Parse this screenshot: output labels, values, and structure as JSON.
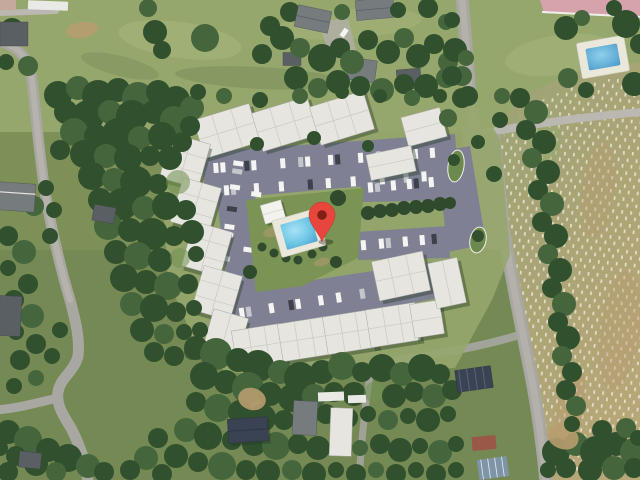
{
  "app": {
    "title": "Satellite map view",
    "description": "Aerial satellite view of an apartment complex with parking loop, central swimming pool and a red dropped-pin location marker; cemetery field on the right, residential houses and tree cover around"
  },
  "marker": {
    "name": "dropped-pin",
    "transform": "translate(322,202)",
    "body_color": "#e8453c",
    "dot_color": "#7e2015",
    "shadow_opacity": "0.3"
  },
  "colors": {
    "grass_base": "#7d9058",
    "grass_field": "#96a76d",
    "grass_light": "#adba80",
    "grass_dark": "#6d8150",
    "forest_dark": "#31four",
    "pink_court": "#d6a2ac",
    "white_line": "#efefec",
    "road": "#a8a7a1",
    "road_light": "#bab8b1",
    "asphalt": "#7f8093",
    "asphalt_light": "#9495a6",
    "roof": "#e6e5e0",
    "roof_shade": "#cdccc5",
    "roof_edge": "#a7a6a0",
    "shadow": "#243a22",
    "cemetery_top": "#9ba374",
    "cemetery_bottom": "#b7a678",
    "headstone": "#efeadb",
    "pool_deck": "#eae7db",
    "pool_water": "#6fc7e6",
    "pool_water_deep": "#4ba0cf",
    "pool_water_light": "#a8e2f4",
    "pavilion": "#f3f2ed",
    "car_white": "#f4f4f2",
    "car_silver": "#c3c7cc",
    "car_dark": "#3c414b",
    "house_gray": "#767b7d",
    "house_gray_dark": "#5a5f63",
    "house_navy": "#3a4353",
    "house_red": "#9a5948",
    "metal_blue": "#7d95a6",
    "trailer_white": "#e9e9e5",
    "dirt": "#b79c6f",
    "hedge": "#2f4a2c",
    "island_green": "#6d8a4e",
    "courtyard": "#7b9355",
    "tree_mid": "#45663c",
    "tree_light": "#6f9150"
  },
  "scene": {
    "landmarks": [
      "apartment-complex",
      "central-swimming-pool",
      "pool-pavilion",
      "parking-loop",
      "entrance-islands",
      "hedge-row",
      "residential-houses",
      "cemetery-field",
      "clay-court-edge",
      "backyard-pool",
      "tree-cover",
      "access-roads"
    ]
  }
}
